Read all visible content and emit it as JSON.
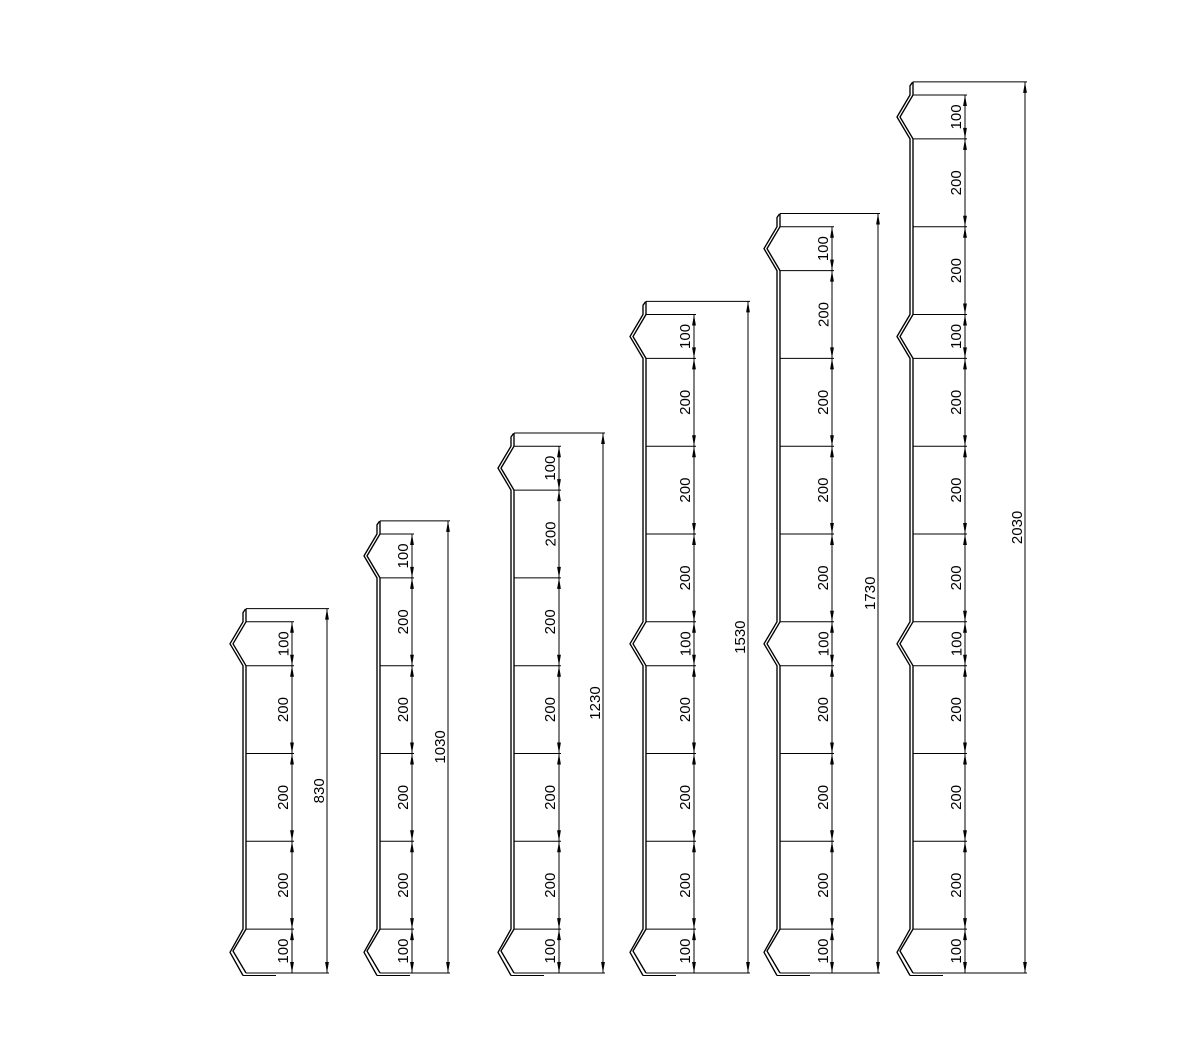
{
  "page": {
    "background_color": "#ffffff"
  },
  "drawing": {
    "line_color": "#000000",
    "text_color": "#000000",
    "description": "six stepped sheet-metal post profiles with chain and overall dimensions",
    "columns": [
      {
        "overall_label": "830",
        "overall_value": 830,
        "segments": [
          {
            "label": "100",
            "value": 100,
            "notch": true
          },
          {
            "label": "200",
            "value": 200,
            "notch": false
          },
          {
            "label": "200",
            "value": 200,
            "notch": false
          },
          {
            "label": "200",
            "value": 200,
            "notch": false
          },
          {
            "label": "100",
            "value": 100,
            "notch": true
          }
        ]
      },
      {
        "overall_label": "1030",
        "overall_value": 1030,
        "segments": [
          {
            "label": "100",
            "value": 100,
            "notch": true
          },
          {
            "label": "200",
            "value": 200,
            "notch": false
          },
          {
            "label": "200",
            "value": 200,
            "notch": false
          },
          {
            "label": "200",
            "value": 200,
            "notch": false
          },
          {
            "label": "200",
            "value": 200,
            "notch": false
          },
          {
            "label": "100",
            "value": 100,
            "notch": true
          }
        ]
      },
      {
        "overall_label": "1230",
        "overall_value": 1230,
        "segments": [
          {
            "label": "100",
            "value": 100,
            "notch": true
          },
          {
            "label": "200",
            "value": 200,
            "notch": false
          },
          {
            "label": "200",
            "value": 200,
            "notch": false
          },
          {
            "label": "200",
            "value": 200,
            "notch": false
          },
          {
            "label": "200",
            "value": 200,
            "notch": false
          },
          {
            "label": "200",
            "value": 200,
            "notch": false
          },
          {
            "label": "100",
            "value": 100,
            "notch": true
          }
        ]
      },
      {
        "overall_label": "1530",
        "overall_value": 1530,
        "segments": [
          {
            "label": "100",
            "value": 100,
            "notch": true
          },
          {
            "label": "200",
            "value": 200,
            "notch": false
          },
          {
            "label": "200",
            "value": 200,
            "notch": false
          },
          {
            "label": "200",
            "value": 200,
            "notch": false
          },
          {
            "label": "100",
            "value": 100,
            "notch": true
          },
          {
            "label": "200",
            "value": 200,
            "notch": false
          },
          {
            "label": "200",
            "value": 200,
            "notch": false
          },
          {
            "label": "200",
            "value": 200,
            "notch": false
          },
          {
            "label": "100",
            "value": 100,
            "notch": true
          }
        ]
      },
      {
        "overall_label": "1730",
        "overall_value": 1730,
        "segments": [
          {
            "label": "100",
            "value": 100,
            "notch": true
          },
          {
            "label": "200",
            "value": 200,
            "notch": false
          },
          {
            "label": "200",
            "value": 200,
            "notch": false
          },
          {
            "label": "200",
            "value": 200,
            "notch": false
          },
          {
            "label": "200",
            "value": 200,
            "notch": false
          },
          {
            "label": "100",
            "value": 100,
            "notch": true
          },
          {
            "label": "200",
            "value": 200,
            "notch": false
          },
          {
            "label": "200",
            "value": 200,
            "notch": false
          },
          {
            "label": "200",
            "value": 200,
            "notch": false
          },
          {
            "label": "100",
            "value": 100,
            "notch": true
          }
        ]
      },
      {
        "overall_label": "2030",
        "overall_value": 2030,
        "segments": [
          {
            "label": "100",
            "value": 100,
            "notch": true
          },
          {
            "label": "200",
            "value": 200,
            "notch": false
          },
          {
            "label": "200",
            "value": 200,
            "notch": false
          },
          {
            "label": "100",
            "value": 100,
            "notch": true
          },
          {
            "label": "200",
            "value": 200,
            "notch": false
          },
          {
            "label": "200",
            "value": 200,
            "notch": false
          },
          {
            "label": "200",
            "value": 200,
            "notch": false
          },
          {
            "label": "100",
            "value": 100,
            "notch": true
          },
          {
            "label": "200",
            "value": 200,
            "notch": false
          },
          {
            "label": "200",
            "value": 200,
            "notch": false
          },
          {
            "label": "200",
            "value": 200,
            "notch": false
          },
          {
            "label": "100",
            "value": 100,
            "notch": true
          }
        ]
      }
    ]
  }
}
